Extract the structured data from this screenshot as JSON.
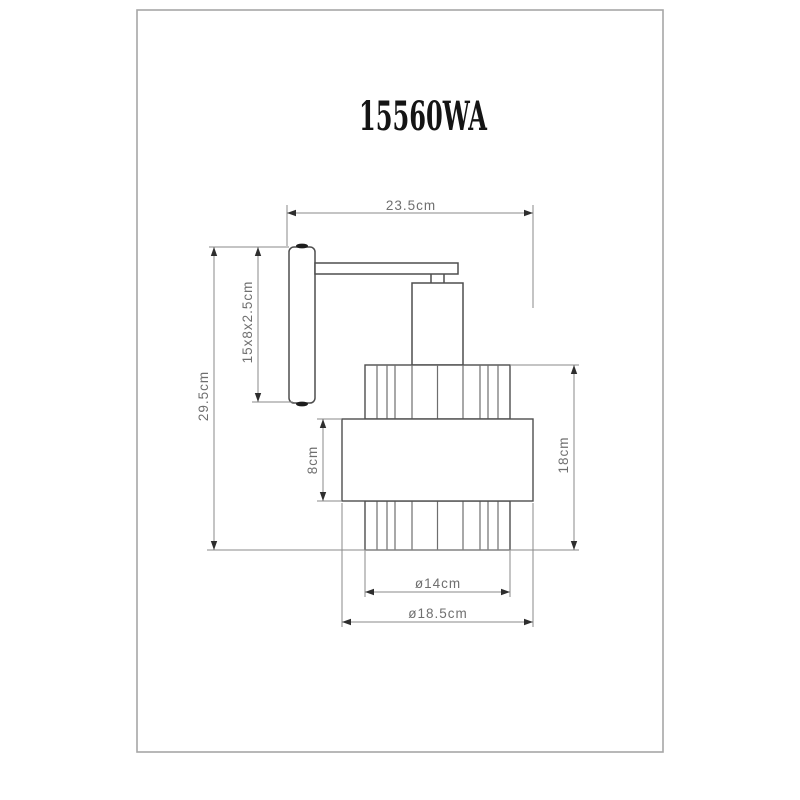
{
  "title": "15560WA",
  "labels": {
    "width": "23.5cm",
    "total_height": "29.5cm",
    "backplate": "15x8x2.5cm",
    "band_height": "8cm",
    "shade_height": "18cm",
    "inner_diameter": "ø14cm",
    "outer_diameter": "ø18.5cm"
  },
  "colors": {
    "object_line": "#4e4e4e",
    "slat_line": "#6e6e6e",
    "dimension_line": "#8a8a8a",
    "arrow": "#2e2e2e",
    "label_text": "#6f6f6f",
    "page_border": "#a6a6a6",
    "title_text": "#141414"
  }
}
